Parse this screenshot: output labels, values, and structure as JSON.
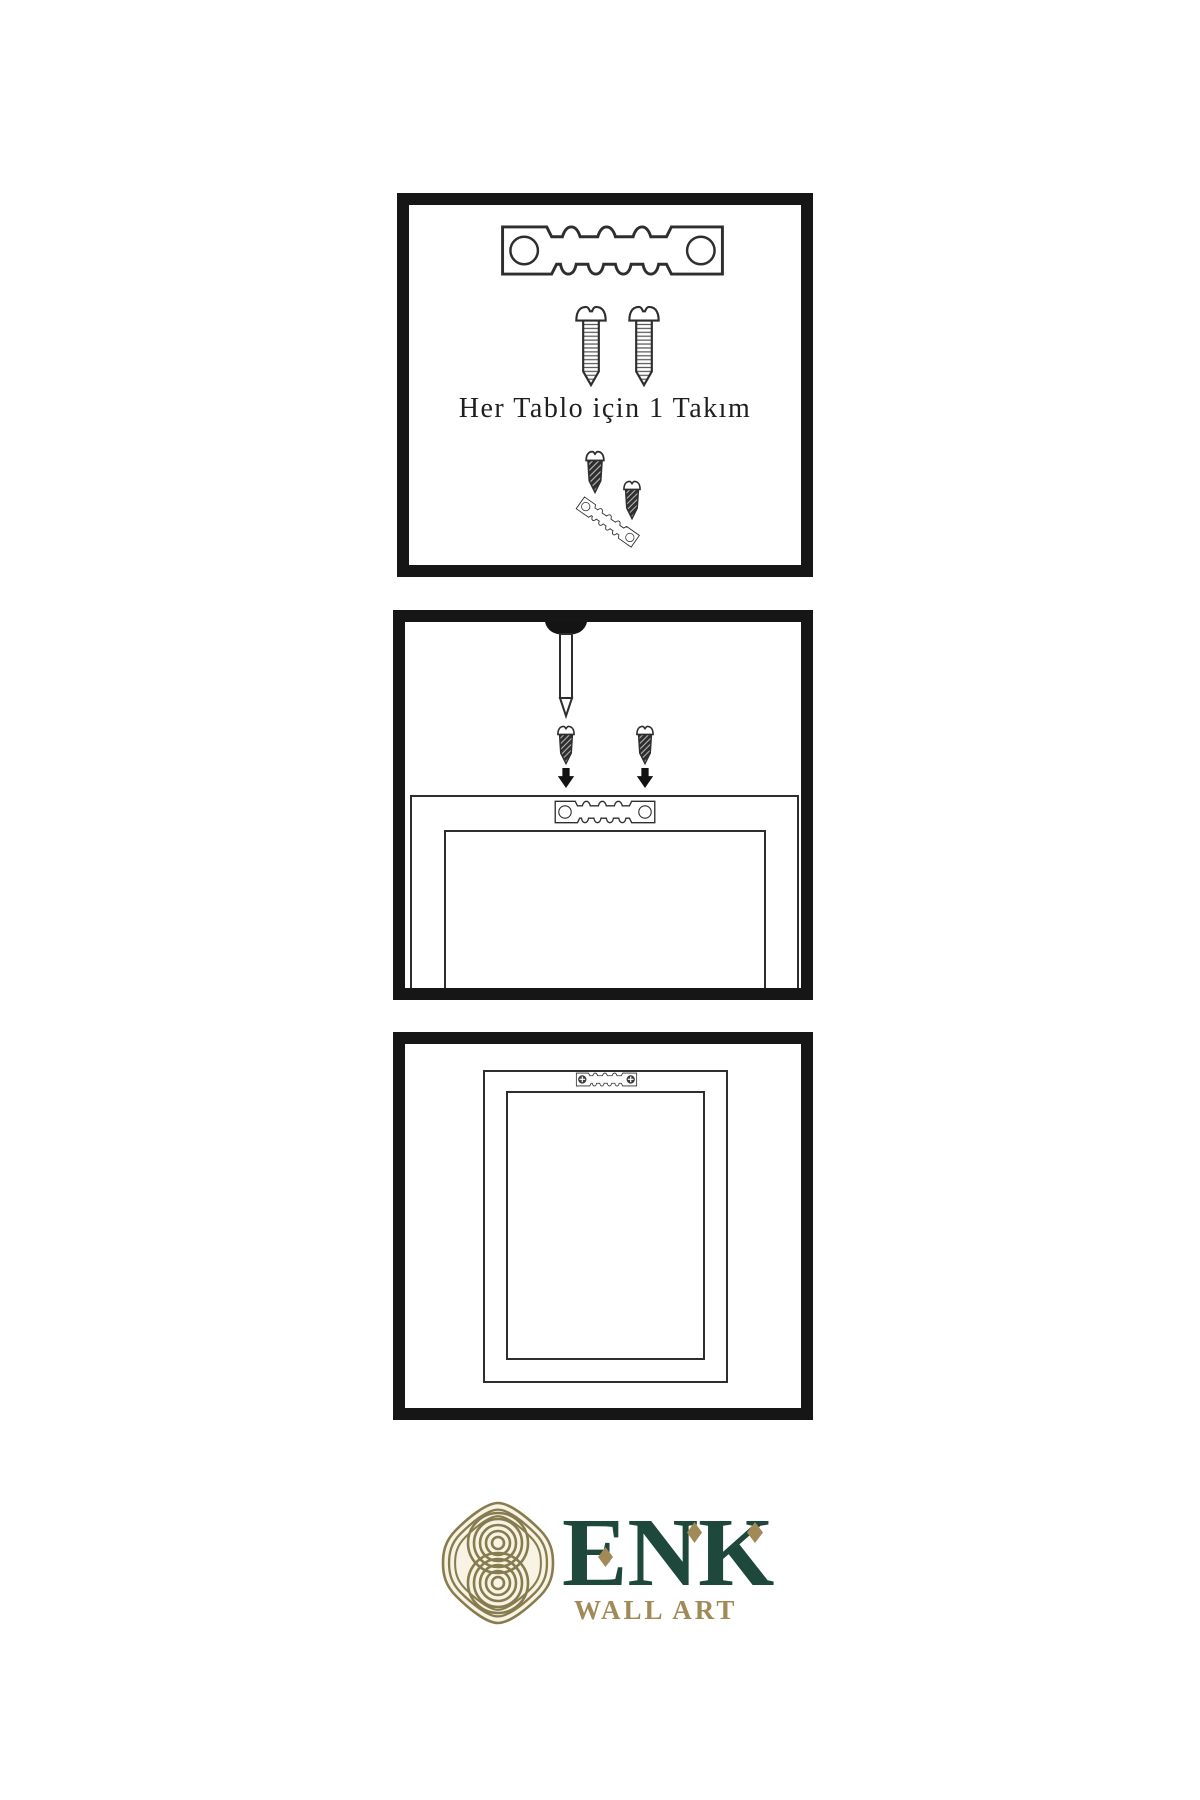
{
  "diagram": {
    "background": "#ffffff",
    "line_color": "#2e2e2e",
    "panel_border_color": "#161616",
    "caption_color": "#1f1f1f"
  },
  "panels": {
    "panel1": {
      "caption": "Her Tablo için 1 Takım",
      "icons": [
        "sawtooth-hanger-icon",
        "screw-icon",
        "screw-icon",
        "screw-into-hanger-icon"
      ]
    },
    "panel2": {
      "icons": [
        "wall-nail-icon",
        "screw-icon",
        "screw-icon",
        "down-arrow-icon",
        "down-arrow-icon",
        "frame-back-with-hanger-icon"
      ]
    },
    "panel3": {
      "icons": [
        "hung-frame-icon",
        "sawtooth-hanger-with-screws-icon"
      ]
    }
  },
  "logo": {
    "brand": "ENK",
    "subtitle": "WALL ART",
    "icon": "knot-icon",
    "colors": {
      "brand_green": "#1d483b",
      "accent_gold": "#a18a58",
      "icon_line_gold": "#867c50",
      "icon_background": "#f8f3e3"
    }
  }
}
